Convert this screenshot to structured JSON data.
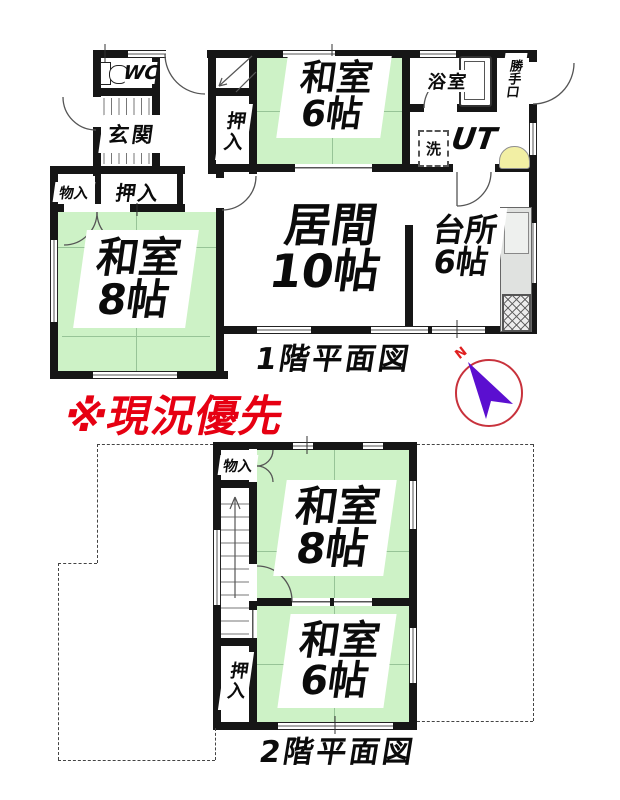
{
  "note": {
    "text": "※現況優先",
    "color": "#e60012"
  },
  "compass": {
    "label": "N",
    "circle_color": "#c8323c",
    "arrow_color": "#5b0fd0"
  },
  "colors": {
    "wall": "#161616",
    "tatami_green": "#cdf2c6",
    "sink_yellow": "#f2efa4",
    "counter_gray": "#e0e2e0"
  },
  "floor1": {
    "caption": "1階平面図",
    "labels": {
      "wc": "WC",
      "genkan": "玄関",
      "stair_closet": "押入",
      "monoire": "物入",
      "oshiire": "押入",
      "bath": "浴室",
      "backdoor": "勝手口",
      "utility": "UT",
      "laundry": "洗"
    },
    "rooms": {
      "washitsu6": {
        "name": "和室",
        "size": "6帖"
      },
      "living": {
        "name": "居間",
        "size": "10帖"
      },
      "kitchen": {
        "name": "台所",
        "size": "6帖"
      },
      "washitsu8": {
        "name": "和室",
        "size": "8帖"
      }
    }
  },
  "floor2": {
    "caption": "2階平面図",
    "labels": {
      "monoire": "物入",
      "oshiire": "押入"
    },
    "rooms": {
      "washitsu8": {
        "name": "和室",
        "size": "8帖"
      },
      "washitsu6": {
        "name": "和室",
        "size": "6帖"
      }
    }
  }
}
